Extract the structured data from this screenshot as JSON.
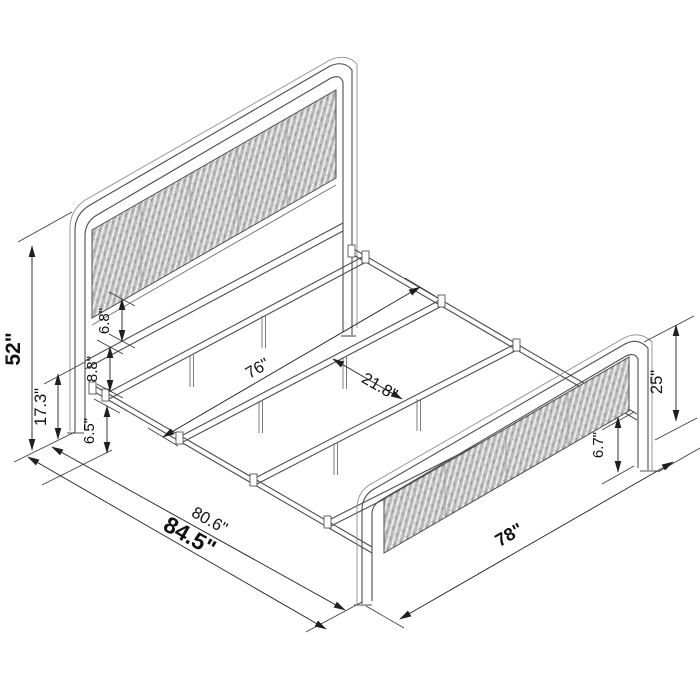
{
  "drawing": {
    "kind": "bed-frame isometric dimension diagram",
    "colors": {
      "line": "#4d4d4d",
      "dimension": "#1f1f1f",
      "panel_fill": "#bdbdbd",
      "panel_weave": "#f2f2f2",
      "background": "#ffffff"
    }
  },
  "dims": {
    "headboard_height": "52\"",
    "rail_top_height": "17.3\"",
    "rail_gap": "8.8\"",
    "panel_to_rail": "6.8\"",
    "under_clearance": "6.5\"",
    "slat_length": "76\"",
    "slat_spacing": "21.8\"",
    "frame_length": "80.6\"",
    "overall_length": "84.5\"",
    "footboard_width": "78\"",
    "footboard_height": "25\"",
    "footboard_panel_gap": "6.7\""
  }
}
